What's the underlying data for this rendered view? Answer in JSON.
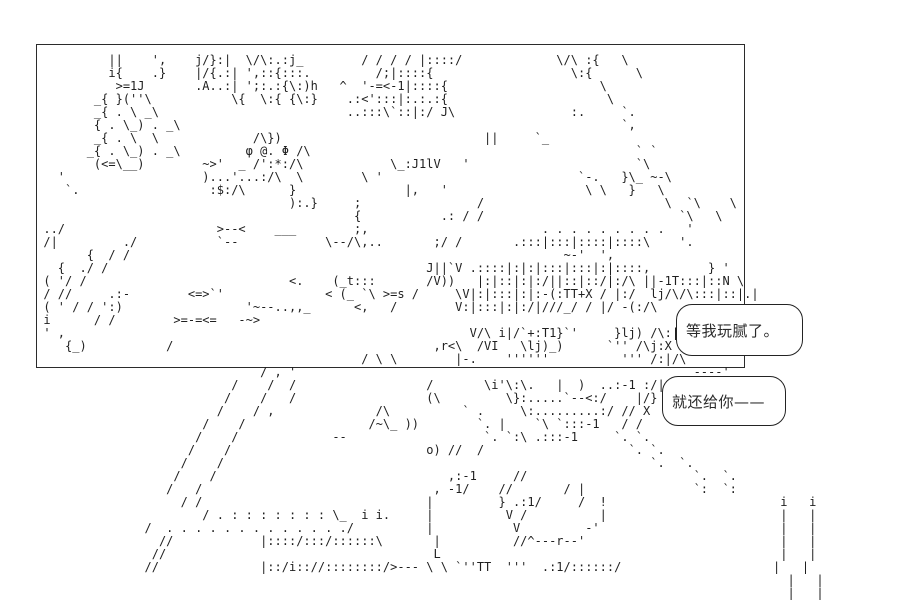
{
  "page": {
    "background": "#ffffff",
    "ink": "#1f1f1f"
  },
  "speech_bubbles": [
    {
      "text": "等我玩腻了。"
    },
    {
      "text": "就还给你——"
    }
  ],
  "ascii_art": {
    "lines": [
      "",
      "",
      "",
      "",
      "               ||    ',    j/}:|  \\/\\:.:j_        / / / / |::::/             \\/\\ :{   \\",
      "               i{    .}    |/{.:| ',::{:::.         /;|::::{                   \\:{      \\",
      "                >=1J       .A..:| ';:.:{\\:)h   ^  '-=<-1|::::{                     \\",
      "             _{ }(''\\           \\{  \\:{ {\\:}    .:<':::|:.:.:{                      \\",
      "             _{ . \\ _\\                          ..:::\\`::|:/ J\\                :.     `.",
      "             { . \\_) . _\\                                                             `,",
      "             _{ . \\  \\             /\\})                            ||     `_",
      "            _{ . \\_) . _\\         φ @. Φ /\\                                             ` `",
      "             (<=\\__)        ~>'  _ /':*:/\\            \\_:J1lV   '                       `\\",
      "        '                   )...'...:/\\  \\        \\ '                           `-.   }\\_ ~-\\",
      "         `.                  :$:/\\      }               |,   '                   \\ \\   }   \\",
      "                                        ):.}     ;                /                         \\  `\\    \\",
      "                                                 {           .: / /                           `\\   \\",
      "      ../                     >--<    ___        ;,                        . . . . . . . . .   '",
      "      /|         ./           `--            \\--/\\,..       ;/ /       .:::|:::|::::|::::\\    '.",
      "            {  / /                                                            ~-'  ',",
      "        {  ./ /                                            J||`V .::::|:|:|:::|:::|:|::::,        } '",
      "      ( '/ /                            <.    (_t:::       /V))   |:|::|:|:/||::|::/|:/\\ ||-1T:::|::N \\",
      "      / //     .:-        <=>`'              < (_ `\\ >=s /     \\V|:|:::|:|:-(:TT+X / |:/  lj/\\/\\:::|::|.|",
      "      ( ' / / ':)                 '~--..,,_      <,   /        V:|:::|:|:/|///_/ / |/ -(:/\\",
      "      i      / /        >=-=<=   -~>                                                           `, }",
      "      ' ,                                                        V/\\ i|/`+:T1}`'     }lj) /\\:|",
      "         {_)           /                                    ,r<\\  /VI   \\lj)_)      `'' /\\j:X",
      "                                                  / \\ \\        |-.    ''''''          ''' /:|/\\",
      "                                    / , '                                                       ----'",
      "                                /    /  /                  /       \\i'\\:\\.   |  )  ..:-1 :/|",
      "                               /    /   /                  (\\         \\}:.....`--<:/    |/}",
      "                              /    / ,              /\\          ` .     \\:.........:/ // X",
      "                            /    /                 /~\\_ ))        `. |    `\\ `:::-1   / /",
      "                           /    /             --                   `. `:\\ .:::-1     `. `.",
      "                          /    /                           o) //  /                    `. `.",
      "                         /    /                                                           `.  `.",
      "                        /    /                                ,:-1     //                       `.  `.",
      "                       /   /                                , -1/    //       / |               `:  `:",
      "                         / /                               |         } .:1/     /  !                        i   i",
      "                            / . : : : : : : : \\_  i i.     |          V /          |                        |   |",
      "                    /  . . . . . . . . . . . . ./          |           V         -'                         |   |",
      "                      //            |::::/:::/::::::\\       |          //^---r--'                           |   |",
      "                     //                                     L                                               |   |",
      "                    //              |::/i:://::::::::/>--- \\ \\ `''TT  '''  .:1/::::::/                     |   |",
      "                                                                                                             |   |",
      "                                                                                                             |   |"
    ]
  }
}
